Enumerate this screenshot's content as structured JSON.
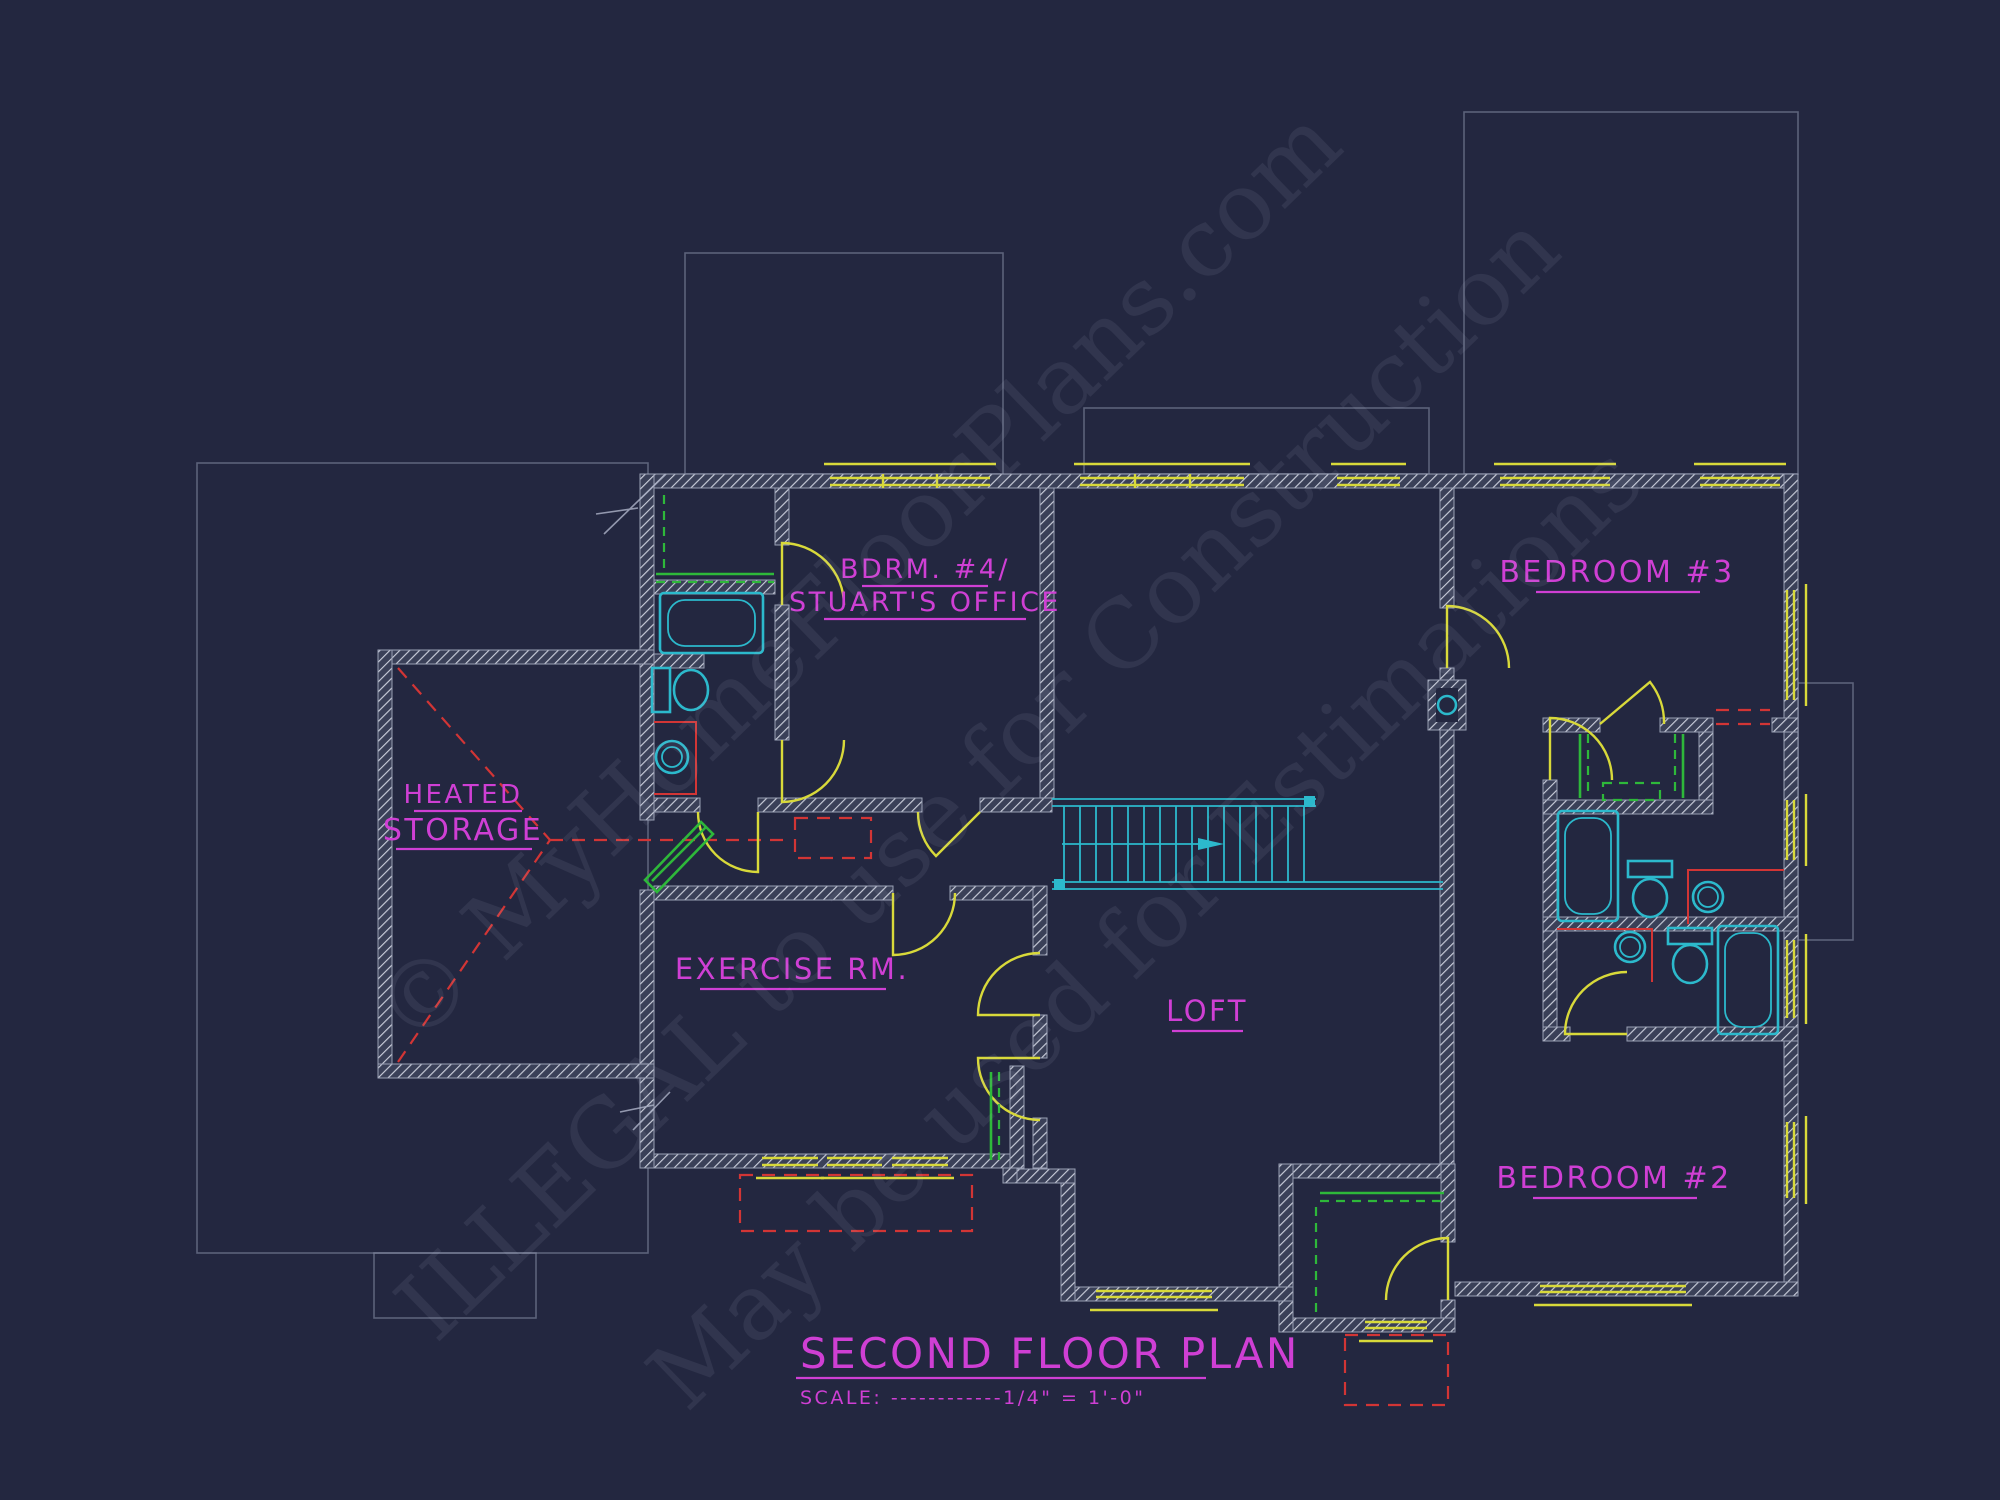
{
  "colors": {
    "bg": "#232740",
    "label": "#cf3fd4",
    "accent": "#d8d93a",
    "fixture": "#2cb9cc",
    "green": "#2eb83a",
    "red": "#d23535",
    "faint": "#8b91a9",
    "watermark": "#c3c9de"
  },
  "title": {
    "text": "SECOND FLOOR PLAN",
    "scale": "SCALE: ------------1/4\" = 1'-0\""
  },
  "rooms": {
    "bdrm4": {
      "line1": "BDRM. #4/",
      "line2": "STUART'S OFFICE"
    },
    "bedroom3": {
      "label": "BEDROOM #3"
    },
    "storage": {
      "line1": "HEATED",
      "line2": "STORAGE"
    },
    "exercise": {
      "label": "EXERCISE RM."
    },
    "loft": {
      "label": "LOFT"
    },
    "bedroom2": {
      "label": "BEDROOM #2"
    }
  },
  "watermark": {
    "line1": "© MyHomeFloorPlans.com",
    "line2": "ILLEGAL to use for Construction",
    "line3": "May be used for Estimations"
  }
}
